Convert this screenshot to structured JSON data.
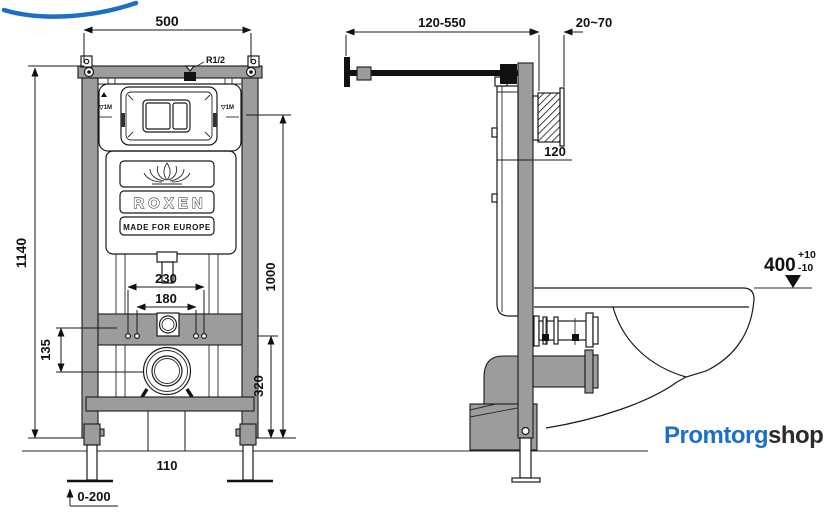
{
  "front_view": {
    "dim_width": "500",
    "dim_height": "1140",
    "dim_stud_outer": "230",
    "dim_stud_inner": "180",
    "dim_drain_offset": "135",
    "dim_plate_height": "1000",
    "dim_stud_height": "320",
    "dim_drain_width": "110",
    "dim_leg_range": "0-200",
    "label_inlet": "R1/2",
    "label_level_left": "▽1M",
    "label_level_right": "▽1M",
    "brand": "ROXEN",
    "tagline": "MADE FOR EUROPE"
  },
  "side_view": {
    "dim_bracket": "120-550",
    "dim_wall": "20~70",
    "dim_depth": "120",
    "dim_seat_height": "400",
    "dim_tol_plus": "+10",
    "dim_tol_minus": "-10"
  },
  "logo": {
    "name_primary": "Promtorg",
    "name_secondary": "shop",
    "blue": "#1c6fc6",
    "dark": "#2b2b2b"
  },
  "colors": {
    "frame_gray": "#9c9c9c",
    "outline": "#1a1a1a",
    "background": "#ffffff",
    "logo_blue": "#1c6fc6"
  }
}
